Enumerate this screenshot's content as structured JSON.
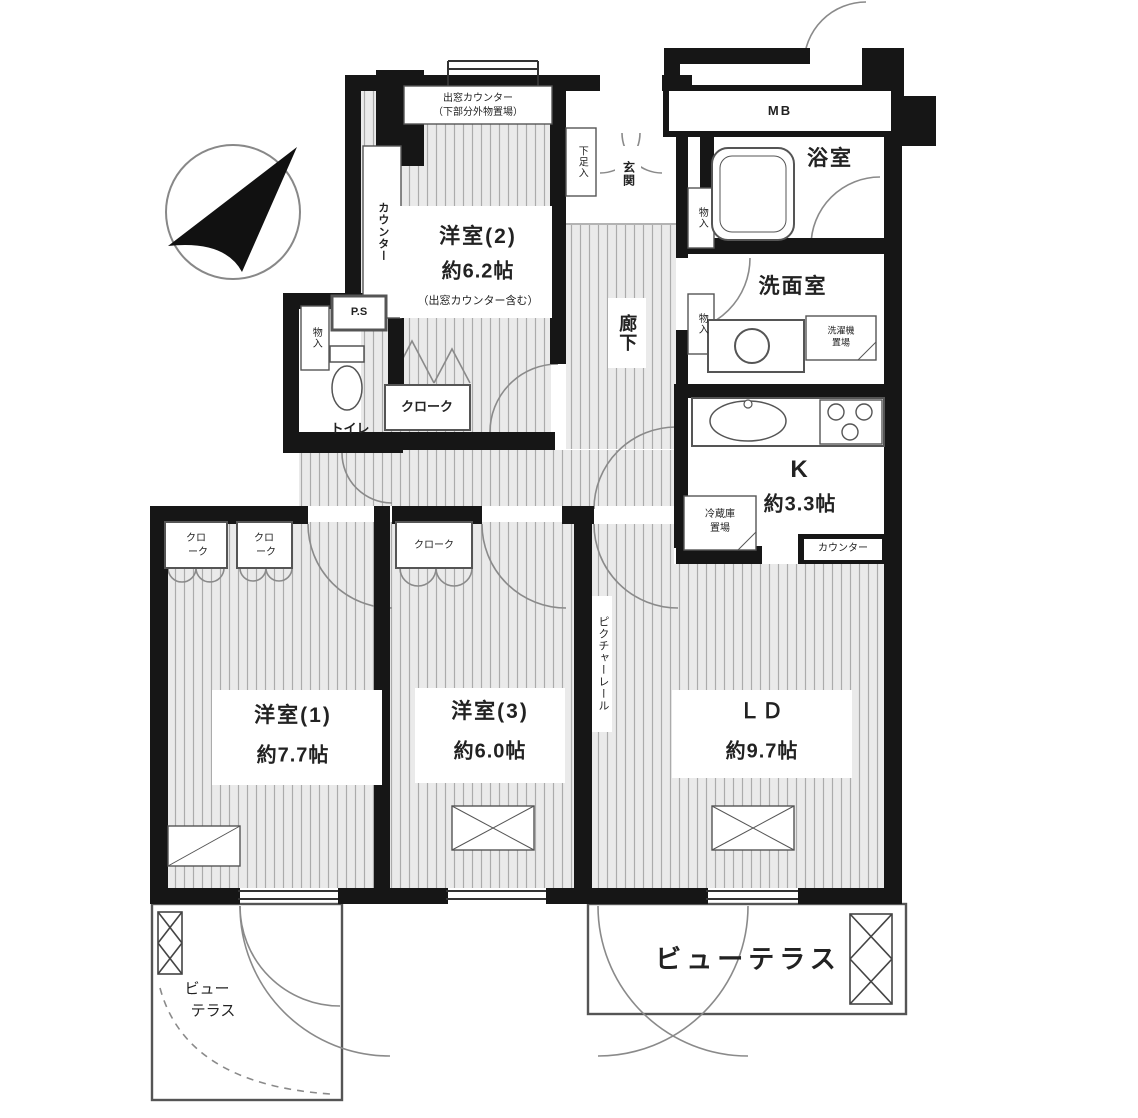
{
  "rooms": {
    "western2": {
      "name": "洋室(2)",
      "size": "約6.2帖",
      "note": "（出窓カウンター含む）"
    },
    "western1": {
      "name": "洋室(1)",
      "size": "約7.7帖"
    },
    "western3": {
      "name": "洋室(3)",
      "size": "約6.0帖"
    },
    "ld": {
      "name": "ＬＤ",
      "size": "約9.7帖"
    },
    "kitchen": {
      "name": "K",
      "size": "約3.3帖"
    },
    "bath": {
      "name": "浴室"
    },
    "washroom": {
      "name": "洗面室"
    },
    "toilet": {
      "name": "トイレ"
    },
    "hallway": {
      "name": "廊下"
    },
    "entrance": {
      "name": "玄関"
    },
    "terrace_main": {
      "name": "ビューテラス"
    },
    "terrace_left": {
      "line1": "ビュー",
      "line2": "テラス"
    }
  },
  "labels": {
    "mb": "MB",
    "ps": "P.S",
    "shoe_storage": "下足入",
    "storage": "物入",
    "counter_vertical": "カウンター",
    "kitchen_counter": "カウンター",
    "cloak": "クローク",
    "cloak_line1": "クロ",
    "cloak_line2": "ーク",
    "bay_window_line1": "出窓カウンター",
    "bay_window_line2": "（下部分外物置場）",
    "washer_line1": "洗濯機",
    "washer_line2": "置場",
    "fridge_line1": "冷蔵庫",
    "fridge_line2": "置場",
    "picture_rail": "ピクチャーレール"
  },
  "colors": {
    "wall": "#161616",
    "floor_bg": "#eaeaea",
    "floor_stripe": "#ababab",
    "thin_line": "#555555",
    "arc_line": "#8a8a8a"
  }
}
